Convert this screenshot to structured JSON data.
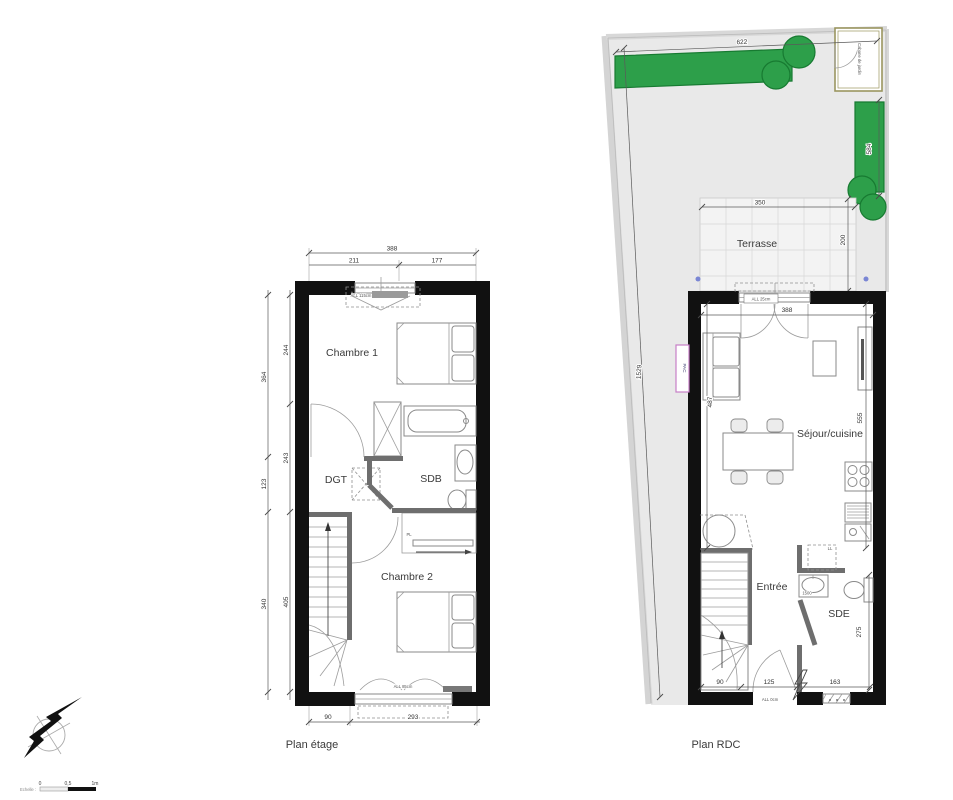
{
  "captions": {
    "etage": "Plan étage",
    "rdc": "Plan RDC"
  },
  "etage": {
    "rooms": {
      "chambre1": "Chambre 1",
      "dgt": "DGT",
      "sdb": "SDB",
      "chambre2": "Chambre 2"
    },
    "labels": {
      "closet": "PL",
      "window_top": "ALL 115cm",
      "window_bottom": "ALL 85cm"
    },
    "dims": {
      "total_width": "388",
      "width_left": "211",
      "width_right": "177",
      "outer": [
        "364",
        "123",
        "340"
      ],
      "inner": [
        "244",
        "243",
        "405"
      ],
      "bottom": [
        "90",
        "293"
      ]
    }
  },
  "rdc": {
    "rooms": {
      "terrasse": "Terrasse",
      "sejour": "Séjour/cuisine",
      "entree": "Entrée",
      "sde": "SDE",
      "cabane": "Cabane de jardin"
    },
    "labels": {
      "pac": "PAC",
      "washer": "LL",
      "vanity": "1500",
      "window_bay": "ALL 25cm",
      "door": "ALL 0cm"
    },
    "dims": {
      "garden_width": "622",
      "garden_right": "584",
      "garden_left": "1529",
      "terrace_width": "350",
      "terrace_depth": "200",
      "bay": "388",
      "sejour_left": "487",
      "sejour_right": "555",
      "sde": "275",
      "bottom": [
        "90",
        "125",
        "163"
      ]
    }
  },
  "legend": {
    "scale_label": "Echelle :",
    "zero": "0",
    "half": "0,5",
    "one": "1m"
  }
}
